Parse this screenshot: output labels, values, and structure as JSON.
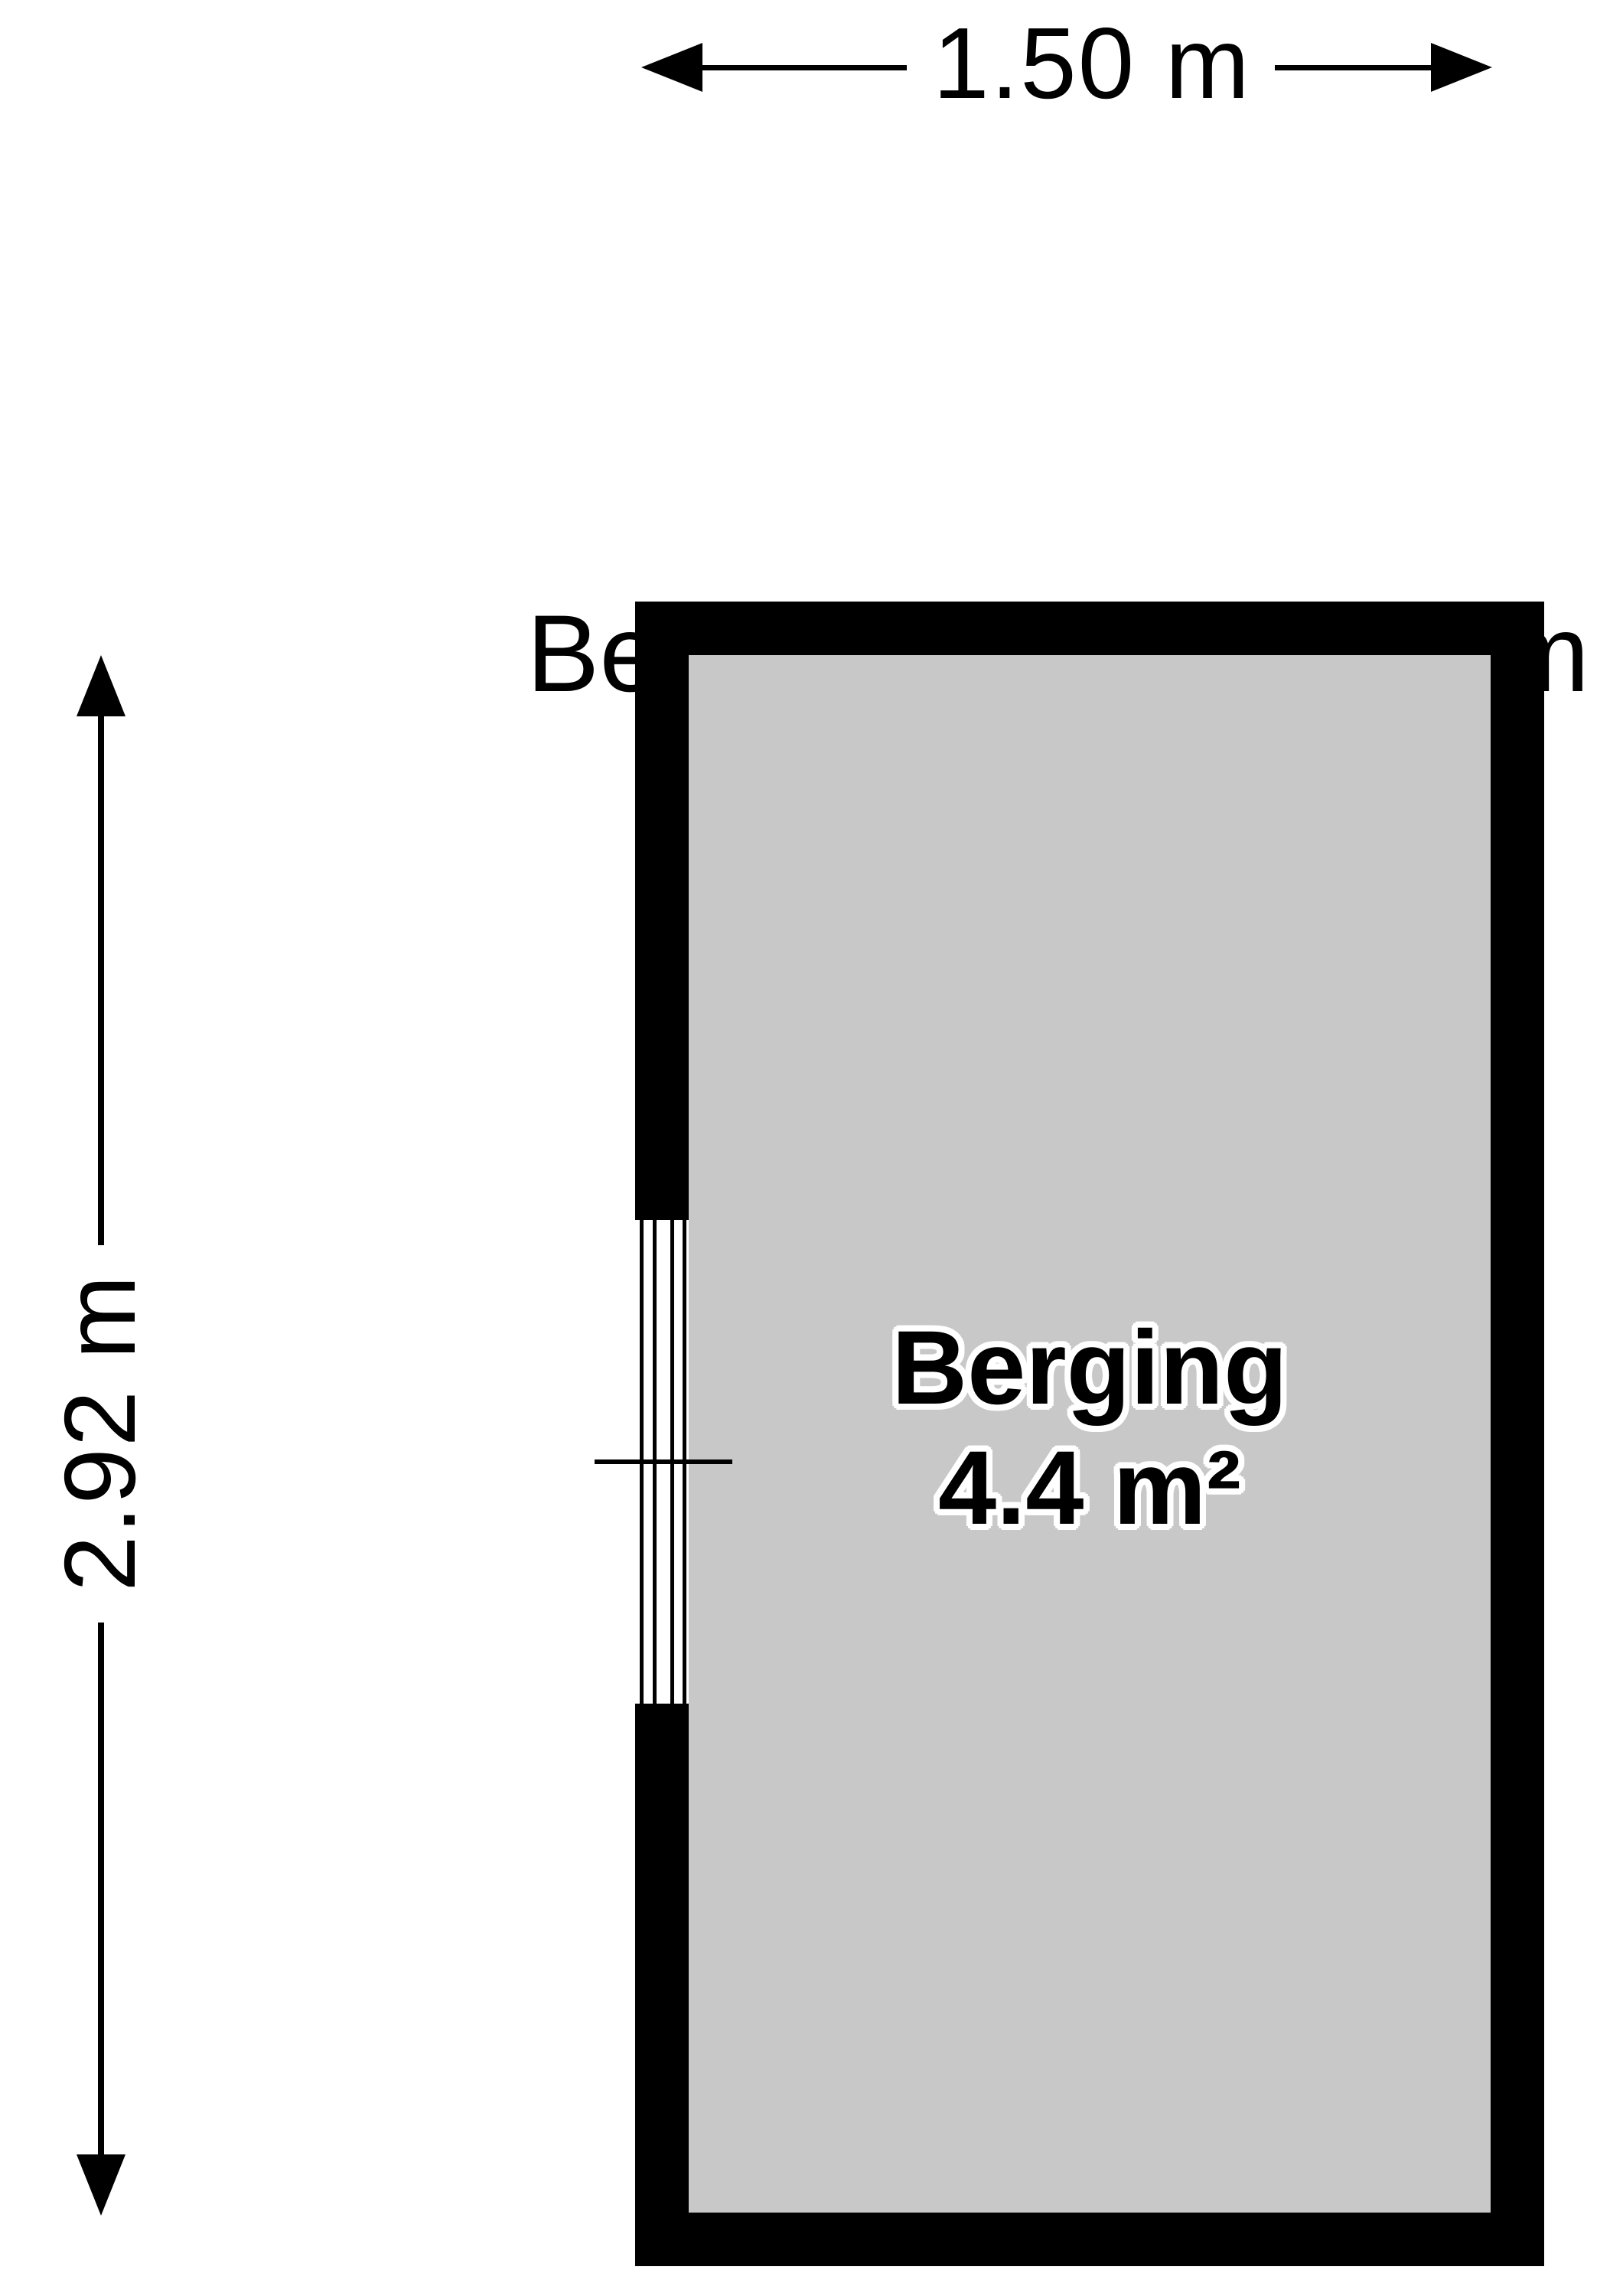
{
  "header": {
    "room_name": "Berging",
    "ceiling_height": "H=2,03m"
  },
  "dimensions": {
    "width_label": "1.50 m",
    "height_label": "2.92 m"
  },
  "room": {
    "name": "Berging",
    "area": "4.4 m²"
  },
  "colors": {
    "wall": "#000000",
    "floor": "#c8c8c8",
    "background": "#ffffff",
    "ink": "#000000"
  }
}
